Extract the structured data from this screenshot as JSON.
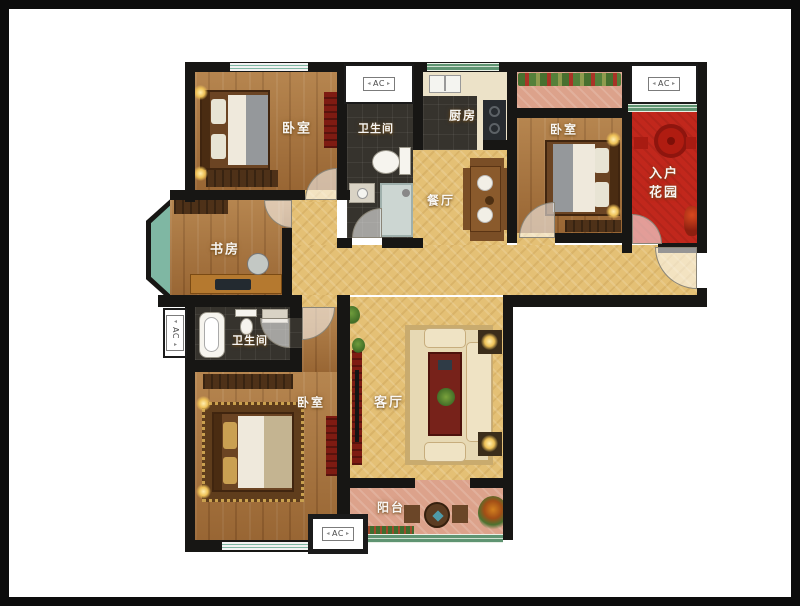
{
  "rooms": {
    "bedroom1": {
      "label": "卧室"
    },
    "bath1": {
      "label": "卫生间"
    },
    "kitchen": {
      "label": "厨房"
    },
    "bedroom2": {
      "label": "卧室"
    },
    "garden": {
      "label_line1": "入户",
      "label_line2": "花园"
    },
    "dining": {
      "label": "餐厅"
    },
    "study": {
      "label": "书房"
    },
    "bath2": {
      "label": "卫生间"
    },
    "bedroom3": {
      "label": "卧室"
    },
    "living": {
      "label": "客厅"
    },
    "balcony": {
      "label": "阳台"
    }
  },
  "markers": {
    "ac": "AC"
  },
  "colors": {
    "wall": "#171614",
    "wood_floor": "#a8743e",
    "tile_yellow": "#e4c075",
    "tile_dark": "#36332d",
    "entry_garden_red": "#c1271c",
    "balcony_pink": "#dca28b",
    "window_teal": "#7fb7a3",
    "window_green": "#5f9472",
    "frame": "#0c0c0c"
  }
}
